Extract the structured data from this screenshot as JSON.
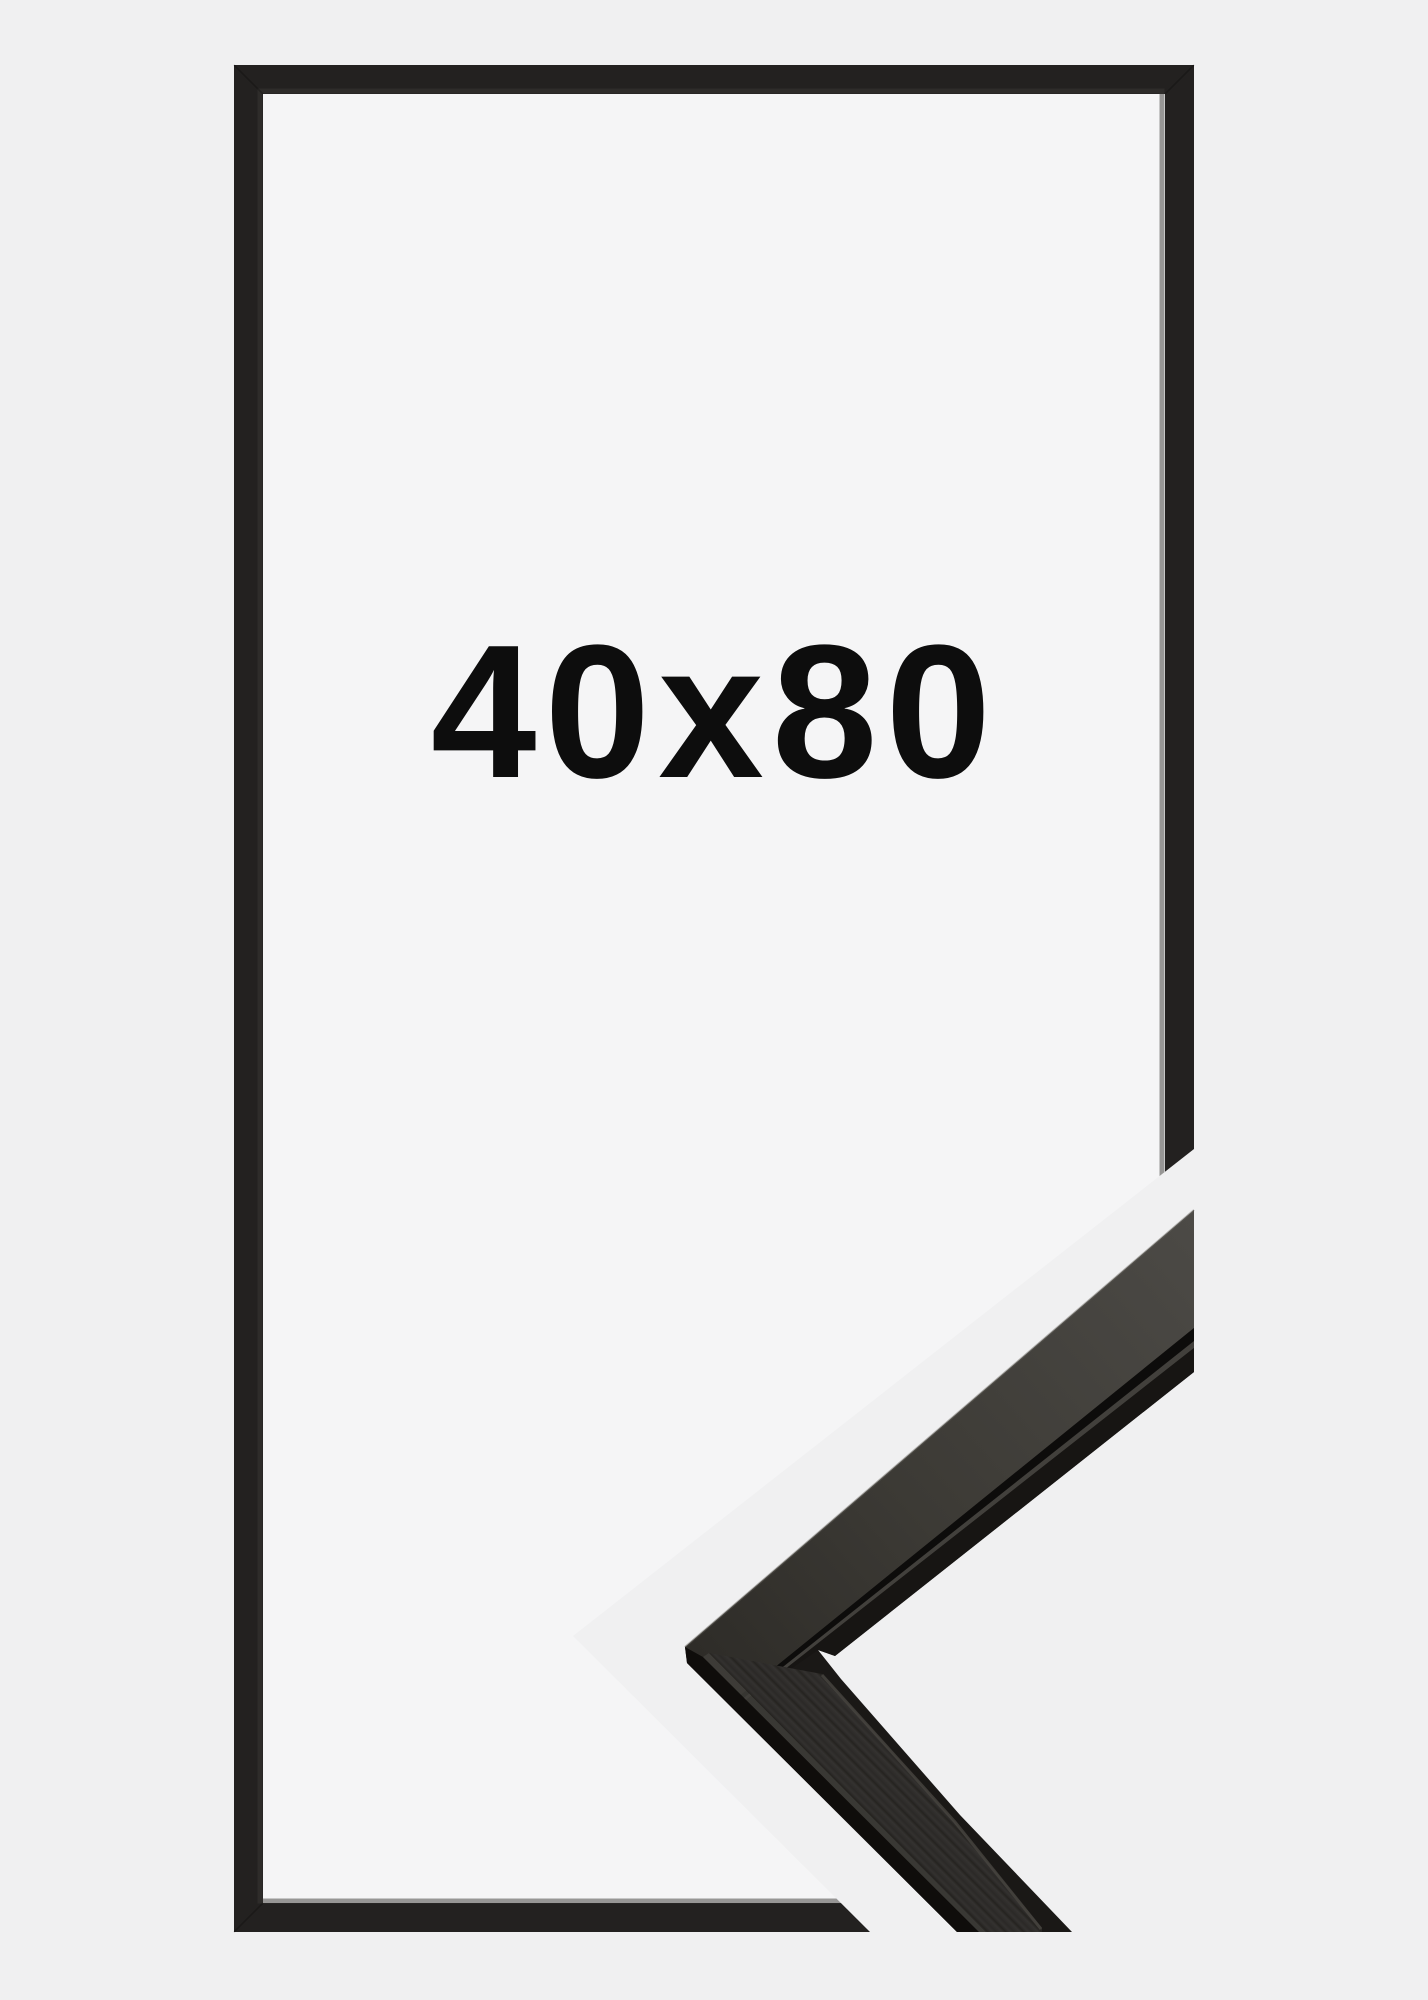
{
  "product": {
    "size_label": "40x80",
    "colors": {
      "page_bg": "#f0f0f1",
      "frame_interior": "#f5f5f6",
      "frame": "#232120",
      "frame_bevel": "#3a3733",
      "label_text": "#0d0d0d",
      "moulding_base": "#1a1816",
      "moulding_face_light": "#4c4a46",
      "moulding_face_mid": "#3c3a35",
      "moulding_face_dark": "#2e2c28",
      "moulding_groove": "#0d0c0b",
      "moulding_ridge": "#474540",
      "moulding_lip": "#171513",
      "moulding_side_edge": "#0f0d0b",
      "moulding_side_sliver": "#403e39",
      "wood_grain_a": "#2b2927",
      "wood_grain_b": "#343230",
      "wood_grain_c": "#252320",
      "moulding_top_rim": "#63615b"
    }
  }
}
